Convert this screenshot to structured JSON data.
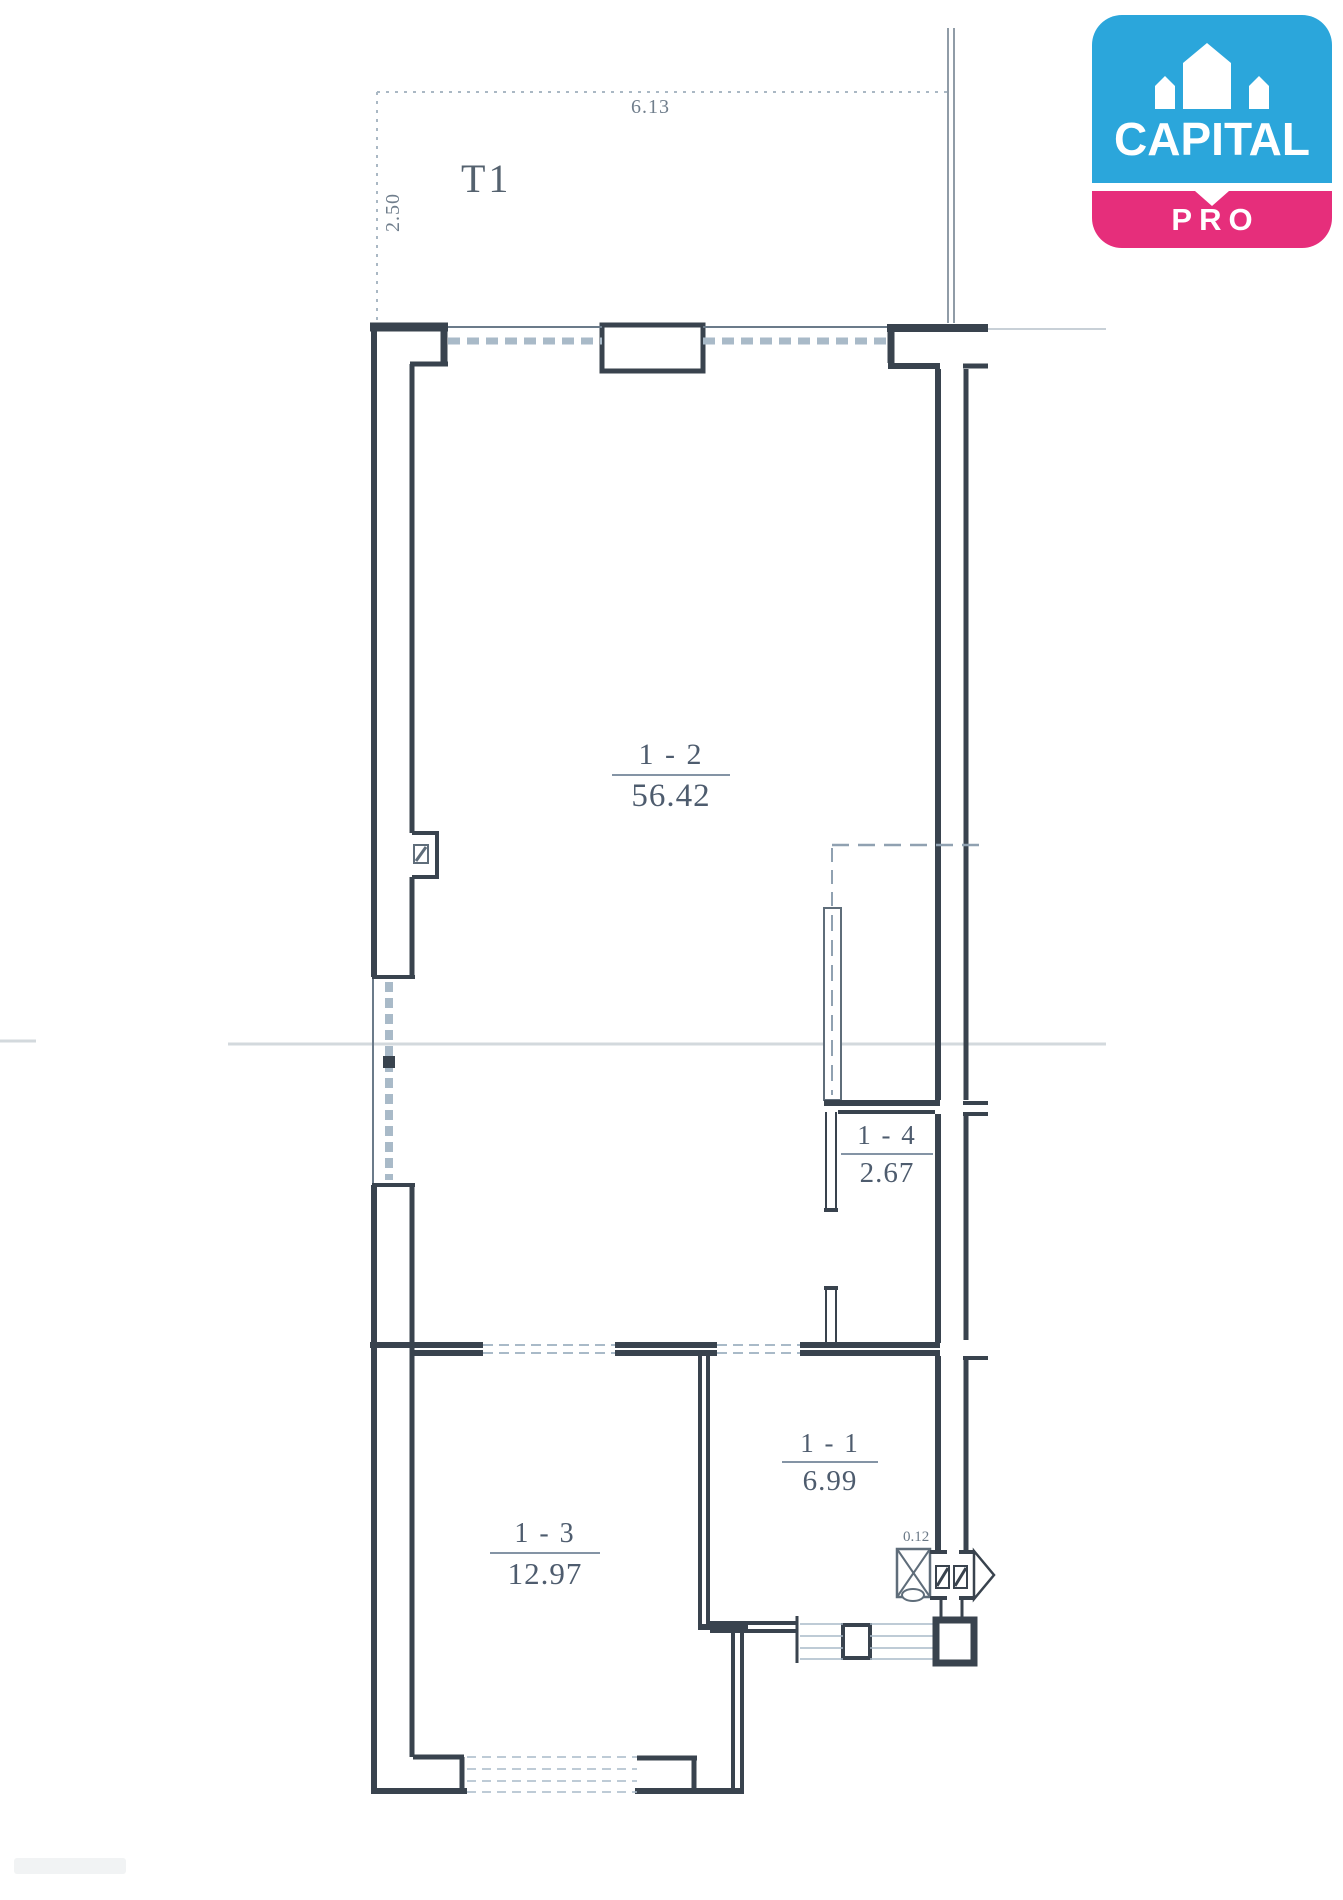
{
  "logo": {
    "brand": "CAPITAL",
    "tier": "PRO",
    "colors": {
      "blue": "#2BA6DB",
      "pink": "#E62E7B"
    }
  },
  "plan": {
    "terrace": {
      "label": "T1",
      "top_dim": "6.13",
      "side_dim": "2.50"
    },
    "rooms": [
      {
        "name": "1 - 2",
        "area": "56.42"
      },
      {
        "name": "1 - 4",
        "area": "2.67"
      },
      {
        "name": "1 - 1",
        "area": "6.99"
      },
      {
        "name": "1 - 3",
        "area": "12.97"
      }
    ],
    "annotations": [
      {
        "text": "0.12"
      }
    ]
  }
}
